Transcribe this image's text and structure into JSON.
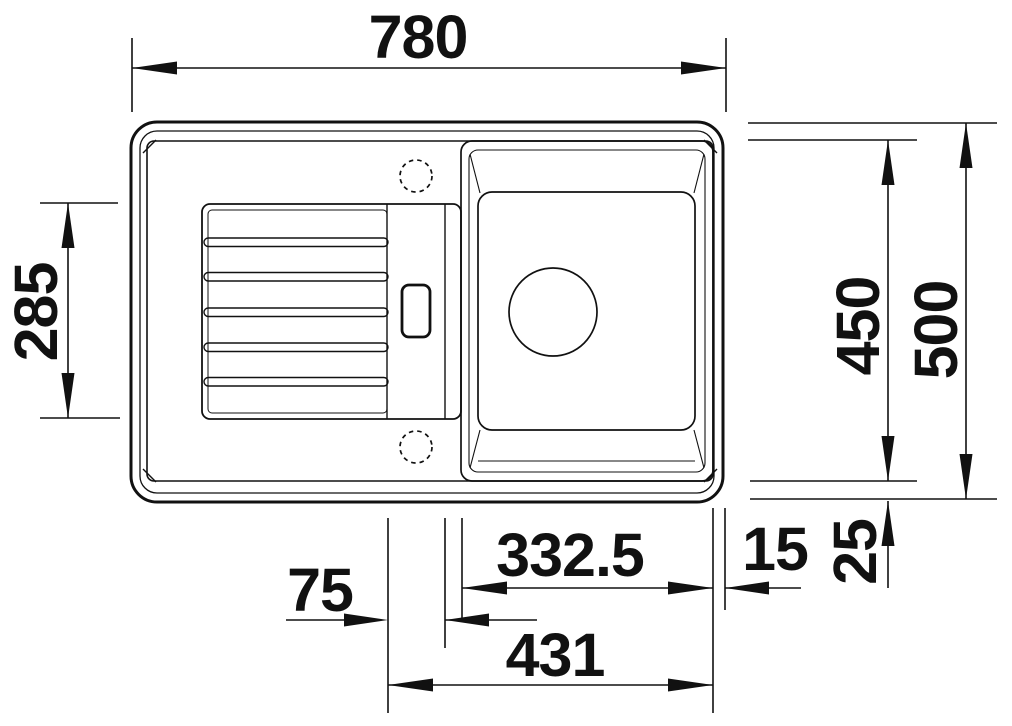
{
  "drawing": {
    "kind": "sink-top-view-technical-drawing",
    "colors": {
      "line": "#111111",
      "background": "#ffffff"
    },
    "dimensions": {
      "overall_width": {
        "label": "780"
      },
      "drainboard_depth": {
        "label": "285"
      },
      "bowl_depth": {
        "label": "450"
      },
      "overall_depth": {
        "label": "500"
      },
      "bowl_width": {
        "label": "332.5"
      },
      "right_rim": {
        "label": "15"
      },
      "bottom_rim": {
        "label": "25"
      },
      "strip_width": {
        "label": "75"
      },
      "bowl_offset": {
        "label": "431"
      }
    }
  }
}
